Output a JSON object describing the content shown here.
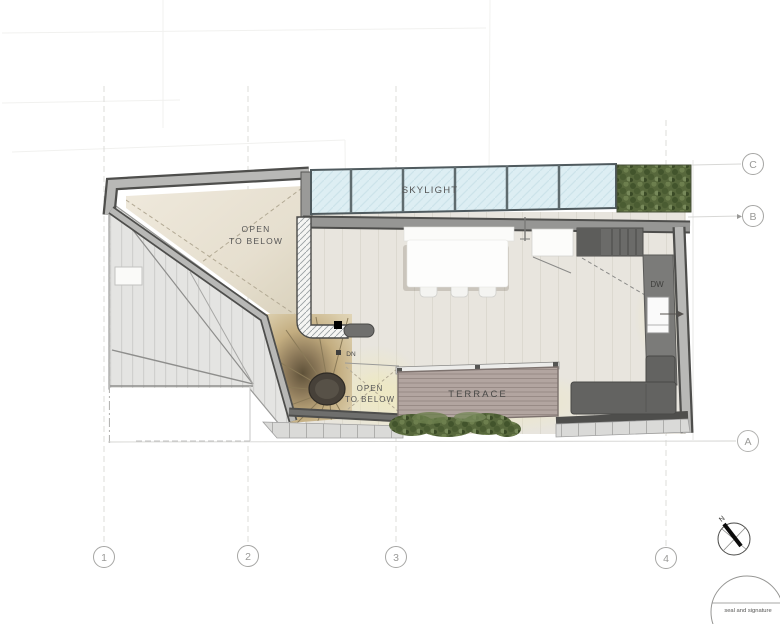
{
  "labels": {
    "skylight": "SKYLIGHT",
    "open_below_top_l1": "OPEN",
    "open_below_top_l2": "TO BELOW",
    "open_below_stair_l1": "OPEN",
    "open_below_stair_l2": "TO BELOW",
    "terrace": "TERRACE",
    "dishwasher": "DW",
    "stair_down": "DN"
  },
  "grid": {
    "columns": [
      {
        "label": "1"
      },
      {
        "label": "2"
      },
      {
        "label": "3"
      },
      {
        "label": "4"
      }
    ],
    "rows": [
      {
        "label": "A"
      },
      {
        "label": "B"
      },
      {
        "label": "C"
      }
    ]
  },
  "north": {
    "label": "N"
  },
  "seal": {
    "label": "seal and signature"
  },
  "colors": {
    "wall_dark": "#4e4e4c",
    "wall_fill": "#b8b8b6",
    "glass": "#ddeef3",
    "floor": "#e8e5de",
    "open_below_floor": "#e6dfcf",
    "deck": "#b2a5a0",
    "foliage": "#57683c",
    "stair_tread": "#c9b488",
    "glow": "#f0e9b8"
  }
}
